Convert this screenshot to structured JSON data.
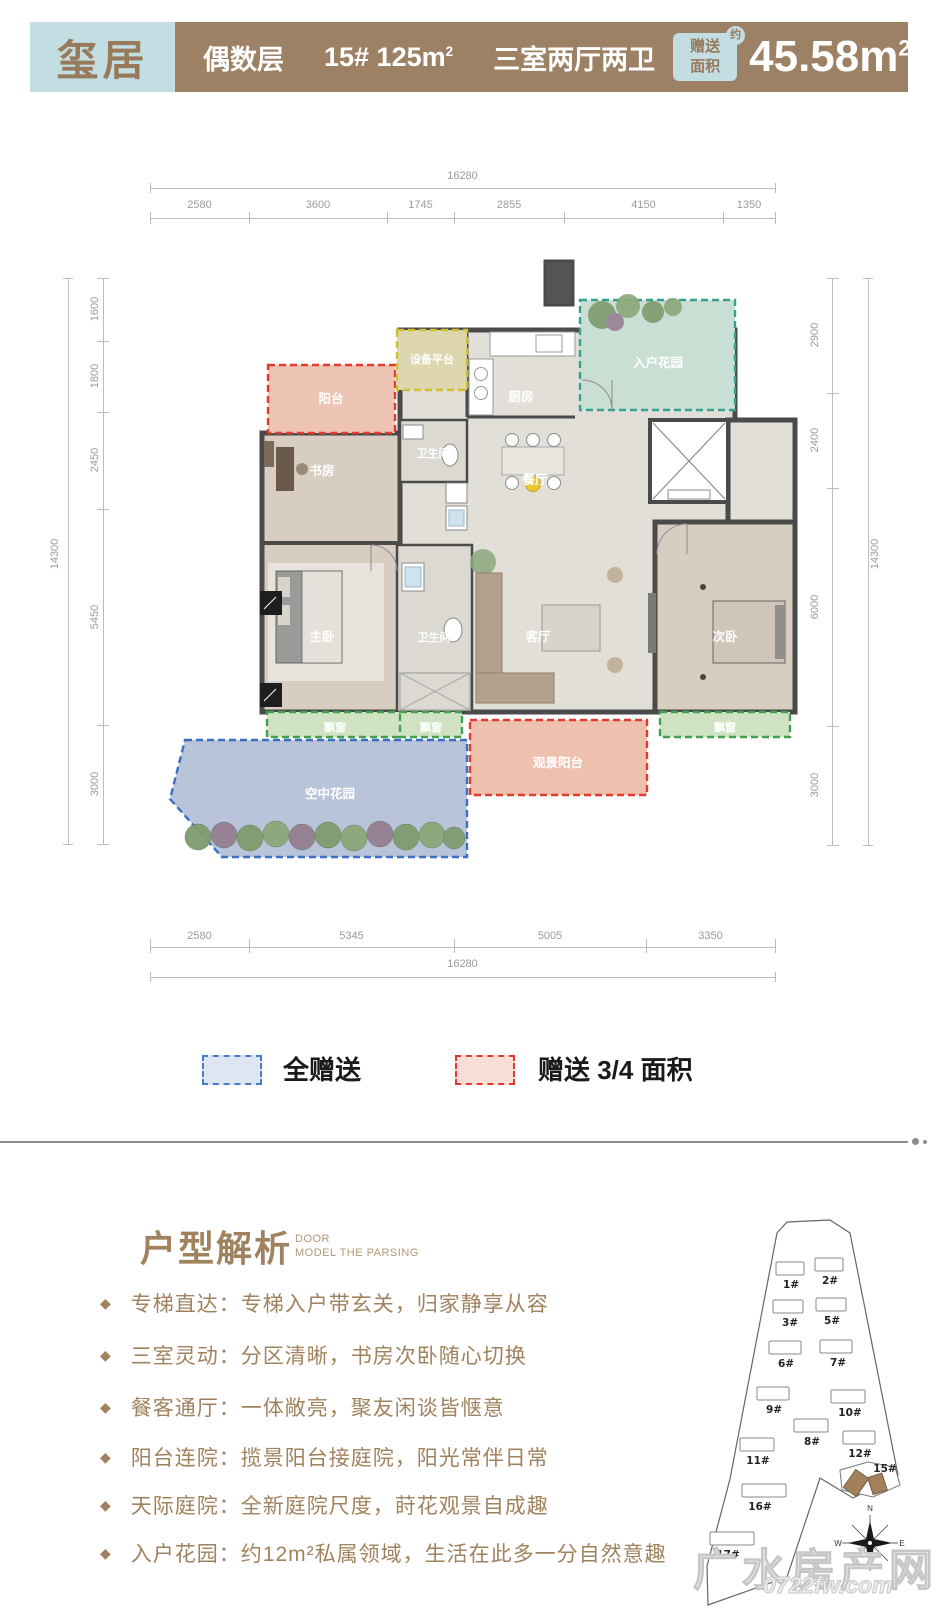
{
  "header": {
    "logo": "玺居",
    "floor_label": "偶数层",
    "unit": "15# 125m",
    "unit_sup": "2",
    "rooms_label": "三室两厅两卫",
    "badge_line1": "赠送",
    "badge_line2": "面积",
    "badge_approx": "约",
    "gift_area": "45.58m",
    "gift_area_sup": "2",
    "colors": {
      "brown": "#9d8164",
      "lightblue": "#c3dee2"
    }
  },
  "floorplan": {
    "dims_top": {
      "total": "16280",
      "segments": [
        "2580",
        "3600",
        "1745",
        "2855",
        "4150",
        "1350"
      ]
    },
    "dims_bottom": {
      "total": "16280",
      "segments": [
        "2580",
        "5345",
        "5005",
        "3350"
      ]
    },
    "dims_left": {
      "total": "14300",
      "segments": [
        "1600",
        "1800",
        "2450",
        "5450",
        "3000"
      ]
    },
    "dims_right": {
      "total": "14300",
      "segments": [
        "2900",
        "2400",
        "6000",
        "3000"
      ]
    },
    "room_labels": [
      "阳台",
      "设备平台",
      "厨房",
      "入户花园",
      "卫生间",
      "书房",
      "餐厅",
      "主卧",
      "卫生间",
      "客厅",
      "次卧",
      "飘窗",
      "飘窗",
      "飘窗",
      "空中花园",
      "观景阳台"
    ]
  },
  "legend": {
    "items": [
      {
        "label": "全赠送",
        "fill": "#dfe6f3",
        "border": "#4a7dc9"
      },
      {
        "label": "赠送 3/4 面积",
        "fill": "#f8ded7",
        "border": "#e03a2f"
      }
    ]
  },
  "analysis": {
    "title": "户型解析",
    "subtitle_line1": "DOOR",
    "subtitle_line2": "MODEL THE PARSING",
    "bullet_icon": "◆",
    "bullets": [
      "专梯直达：专梯入户带玄关，归家静享从容",
      "三室灵动：分区清晰，书房次卧随心切换",
      "餐客通厅：一体敞亮，聚友闲谈皆惬意",
      "阳台连院：揽景阳台接庭院，阳光常伴日常",
      "天际庭院：全新庭院尺度，莳花观景自成趣",
      "入户花园：约12m²私属领域，生活在此多一分自然意趣"
    ]
  },
  "sitemap": {
    "buildings": [
      "1#",
      "2#",
      "3#",
      "5#",
      "6#",
      "7#",
      "9#",
      "10#",
      "8#",
      "11#",
      "12#",
      "15#",
      "16#",
      "17#"
    ],
    "highlighted": "15#",
    "highlight_color": "#a3805c",
    "compass": {
      "n": "N",
      "w": "W",
      "e": "E"
    }
  },
  "watermark": {
    "line1": "广水房产网",
    "line2": "0722fw.com"
  }
}
